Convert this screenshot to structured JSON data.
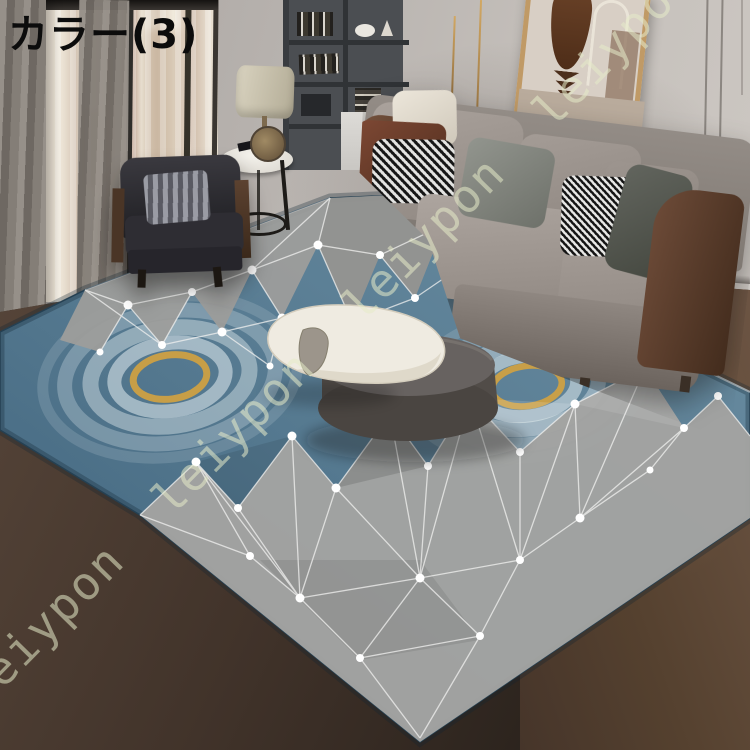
{
  "label": {
    "text": "カラー(3)"
  },
  "watermark": {
    "word": "leiypon",
    "line": "leiypon leiypon leiypon leiypon leiypon"
  },
  "scene": {
    "description": "Modern living room product photo: gray fabric sofa with leather arms and patterned pillows, dark armchair, bookshelf, table lamp on round side table, abstract framed art, round dark ottoman coffee table with white sculptural tray, geometric blue/gray rug with gold rings on dark wood floor, floor-to-ceiling window with city view",
    "colors": {
      "wall": "#bfbab6",
      "floor_dark": "#3f332a",
      "floor_warm": "#5d4a3a",
      "rug_blue": "#54788f",
      "rug_gray": "#a3a3a1",
      "rug_gold_ring": "#cda043",
      "rug_line_white": "#ffffff",
      "sofa_fabric": "#a09893",
      "sofa_leather": "#6b4836",
      "armchair": "#2b2b30",
      "lamp_shade": "#cfc9b6",
      "watermark_tint": "#e6ebc8",
      "label_color": "#0c0c0c"
    }
  }
}
